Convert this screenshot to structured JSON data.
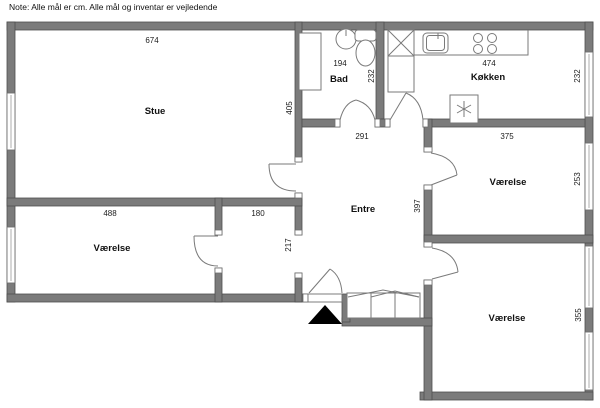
{
  "note": "Note: Alle mål er cm. Alle mål og inventar er vejledende",
  "rooms": {
    "stue": {
      "label": "Stue",
      "width": "674",
      "height": "405"
    },
    "bad": {
      "label": "Bad",
      "width": "194",
      "height": "232"
    },
    "kitchen": {
      "label": "Køkken",
      "width": "474",
      "height": "232"
    },
    "entre": {
      "label": "Entre",
      "width": "291",
      "height": "397"
    },
    "room_right_mid": {
      "label": "Værelse",
      "width": "375",
      "height": "253"
    },
    "room_left": {
      "label": "Værelse",
      "width": "488"
    },
    "hall_nook": {
      "width": "180",
      "height": "217"
    },
    "room_right_bottom": {
      "label": "Værelse",
      "height": "355"
    }
  },
  "colors": {
    "wall_fill": "#7b7b7b",
    "wall_edge": "#4f4f4f",
    "fixture_line": "#777777",
    "text": "#111111",
    "entrance_arrow": "#000000",
    "background": "#ffffff"
  }
}
